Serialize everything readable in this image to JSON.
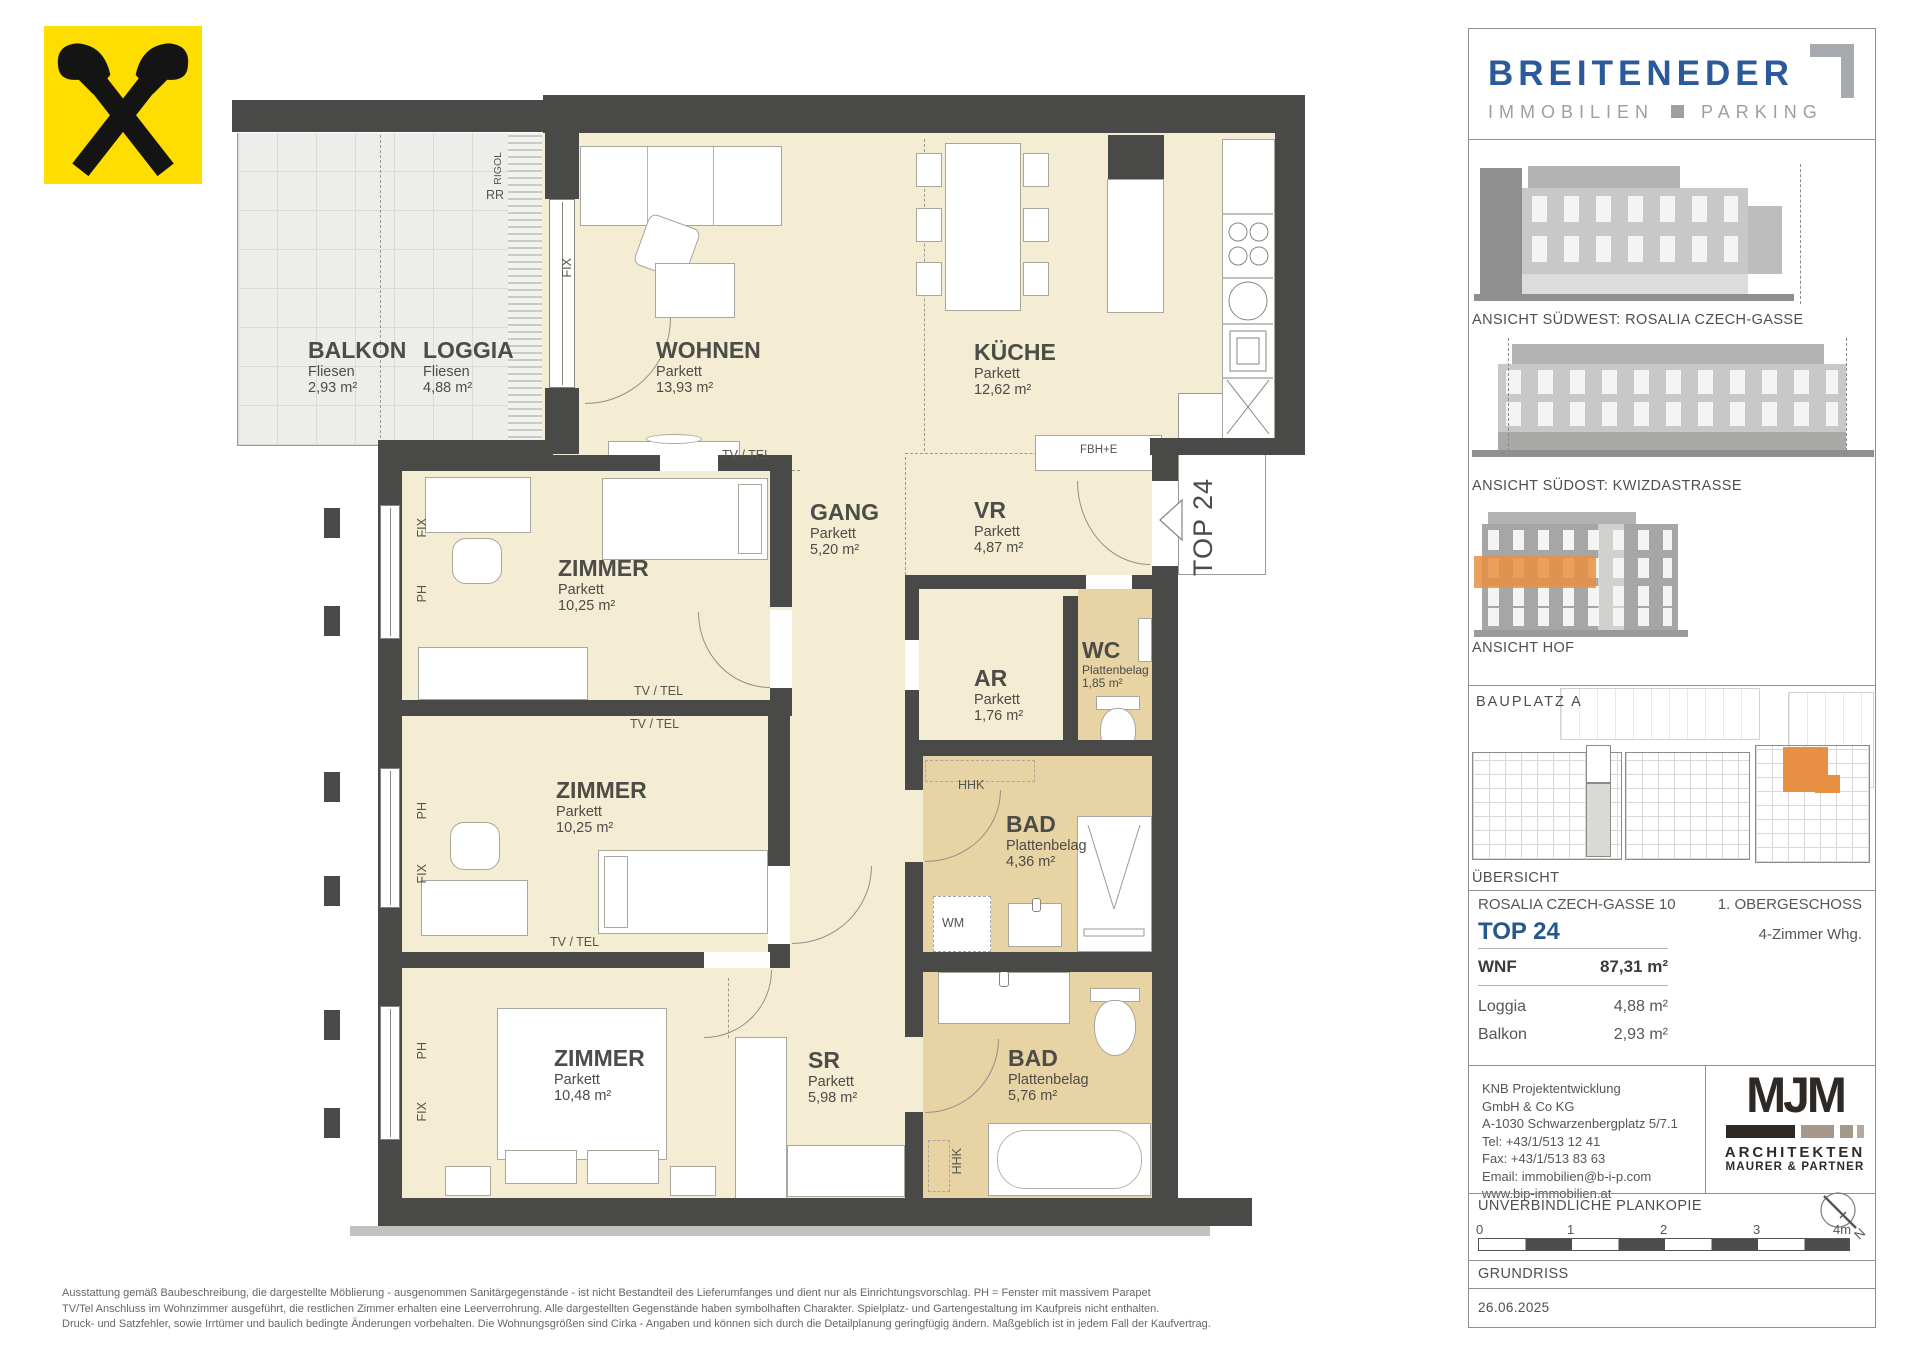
{
  "colors": {
    "brand_blue": "#2a5a9c",
    "logo_gray": "#9aa0a5",
    "wall_gray": "#494947",
    "floor_cream": "#f4edd3",
    "wet_room_tan": "#e8d3a4",
    "highlight_orange": "#e78f42",
    "raiffeisen_yellow": "#fede00"
  },
  "plan": {
    "rooms": [
      {
        "name": "BALKON",
        "floor": "Fliesen",
        "area": "2,93 m²"
      },
      {
        "name": "LOGGIA",
        "floor": "Fliesen",
        "area": "4,88 m²"
      },
      {
        "name": "WOHNEN",
        "floor": "Parkett",
        "area": "13,93 m²"
      },
      {
        "name": "KÜCHE",
        "floor": "Parkett",
        "area": "12,62 m²"
      },
      {
        "name": "ZIMMER",
        "floor": "Parkett",
        "area": "10,25 m²"
      },
      {
        "name": "GANG",
        "floor": "Parkett",
        "area": "5,20 m²"
      },
      {
        "name": "VR",
        "floor": "Parkett",
        "area": "4,87 m²"
      },
      {
        "name": "AR",
        "floor": "Parkett",
        "area": "1,76 m²"
      },
      {
        "name": "WC",
        "floor": "Plattenbelag",
        "area": "1,85 m²"
      },
      {
        "name": "ZIMMER",
        "floor": "Parkett",
        "area": "10,25 m²"
      },
      {
        "name": "BAD",
        "floor": "Plattenbelag",
        "area": "4,36 m²"
      },
      {
        "name": "ZIMMER",
        "floor": "Parkett",
        "area": "10,48 m²"
      },
      {
        "name": "SR",
        "floor": "Parkett",
        "area": "5,98 m²"
      },
      {
        "name": "BAD",
        "floor": "Plattenbelag",
        "area": "5,76 m²"
      }
    ],
    "labels": {
      "top_unit": "TOP 24",
      "tv_tel": "TV / TEL",
      "fix": "FIX",
      "ph": "PH",
      "rigol": "RIGOL",
      "rr": "RR",
      "fbh_e": "FBH+E",
      "hhk": "HHK",
      "wm": "WM"
    }
  },
  "sidebar": {
    "brand": {
      "name": "BREITENEDER",
      "category1": "IMMOBILIEN",
      "category2": "PARKING"
    },
    "views": [
      {
        "caption": "ANSICHT SÜDWEST: ROSALIA CZECH-GASSE"
      },
      {
        "caption": "ANSICHT SÜDOST: KWIZDASTRASSE"
      },
      {
        "caption": "ANSICHT HOF"
      }
    ],
    "site": {
      "label": "BAUPLATZ A",
      "caption": "ÜBERSICHT"
    },
    "info": {
      "address": "ROSALIA CZECH-GASSE 10",
      "floor": "1. OBERGESCHOSS",
      "unit": "TOP 24",
      "type": "4-Zimmer Whg.",
      "rows": [
        {
          "label": "WNF",
          "value": "87,31 m²"
        },
        {
          "label": "Loggia",
          "value": "4,88 m²"
        },
        {
          "label": "Balkon",
          "value": "2,93 m²"
        }
      ]
    },
    "contact": {
      "lines": [
        "KNB Projektentwicklung",
        "GmbH & Co KG",
        "A-1030 Schwarzenbergplatz 5/7.1",
        "Tel: +43/1/513 12 41",
        "Fax: +43/1/513 83 63",
        "Email: immobilien@b-i-p.com",
        "www.bip-immobilien.at"
      ]
    },
    "architect": {
      "initials": "MJM",
      "line1": "ARCHITEKTEN",
      "line2": "MAURER & PARTNER"
    },
    "plancopy": "UNVERBINDLICHE PLANKOPIE",
    "scale_ticks": [
      "0",
      "1",
      "2",
      "3",
      "4m"
    ],
    "drawing_type": "GRUNDRISS",
    "date": "26.06.2025",
    "north": "N"
  },
  "footer": {
    "lines": [
      "Ausstattung gemäß Baubeschreibung, die dargestellte Möblierung - ausgenommen Sanitärgegenstände - ist nicht Bestandteil des Lieferumfanges und dient nur als Einrichtungsvorschlag. PH = Fenster mit massivem Parapet",
      "TV/Tel Anschluss im Wohnzimmer ausgeführt, die restlichen Zimmer erhalten eine Leerverrohrung. Alle dargestellten Gegenstände haben symbolhaften Charakter. Spielplatz- und Gartengestaltung im Kaufpreis nicht enthalten.",
      "Druck- und Satzfehler, sowie Irrtümer und baulich bedingte Änderungen vorbehalten. Die Wohnungsgrößen sind Cirka - Angaben und können sich durch die Detailplanung geringfügig ändern. Maßgeblich ist in jedem Fall der Kaufvertrag."
    ]
  }
}
